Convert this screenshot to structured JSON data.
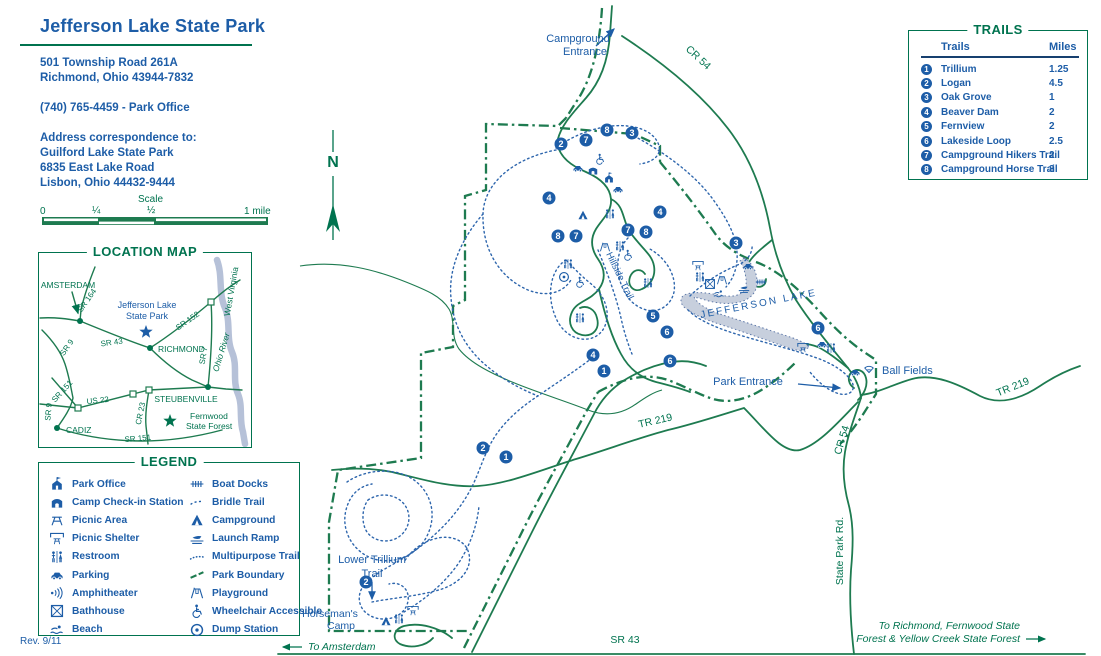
{
  "colors": {
    "blue": "#1d5da7",
    "green_text": "#00734f",
    "green_line": "#1e7b50",
    "lake_fill": "#c7cfdd",
    "marker_bg": "#1d5da7"
  },
  "header": {
    "title": "Jefferson Lake State Park",
    "lines": [
      "501 Township Road 261A",
      "Richmond, Ohio 43944-7832",
      "",
      "(740) 765-4459 - Park Office",
      "",
      "Address correspondence to:",
      "Guilford Lake State Park",
      "6835 East Lake Road",
      "Lisbon, Ohio 44432-9444"
    ]
  },
  "scale": {
    "title": "Scale",
    "ticks": [
      "0",
      "¼",
      "½",
      "1 mile"
    ]
  },
  "location_map": {
    "title": "LOCATION MAP",
    "city_dots": [
      {
        "x": 80,
        "y": 321
      },
      {
        "x": 150,
        "y": 348
      },
      {
        "x": 208,
        "y": 387
      },
      {
        "x": 57,
        "y": 428
      }
    ],
    "squares": [
      {
        "x": 211,
        "y": 302
      },
      {
        "x": 133,
        "y": 394
      },
      {
        "x": 149,
        "y": 390
      },
      {
        "x": 78,
        "y": 408
      }
    ],
    "stars": [
      {
        "x": 146,
        "y": 332,
        "c": "#1d5da7"
      },
      {
        "x": 170,
        "y": 421,
        "c": "#00734f"
      }
    ]
  },
  "legend": {
    "title": "LEGEND",
    "columns": [
      [
        {
          "icon": "park-office",
          "label": "Park Office"
        },
        {
          "icon": "checkin",
          "label": "Camp Check-in Station"
        },
        {
          "icon": "picnic-area",
          "label": "Picnic Area"
        },
        {
          "icon": "picnic-shelter",
          "label": "Picnic Shelter"
        },
        {
          "icon": "restroom",
          "label": "Restroom"
        },
        {
          "icon": "parking",
          "label": "Parking"
        },
        {
          "icon": "amphitheater",
          "label": "Amphitheater"
        },
        {
          "icon": "bathhouse",
          "label": "Bathhouse"
        },
        {
          "icon": "beach",
          "label": "Beach"
        }
      ],
      [
        {
          "icon": "boat-docks",
          "label": "Boat Docks"
        },
        {
          "icon": "bridle-trail",
          "label": "Bridle Trail"
        },
        {
          "icon": "campground",
          "label": "Campground"
        },
        {
          "icon": "launch-ramp",
          "label": "Launch Ramp"
        },
        {
          "icon": "multipurpose-trail",
          "label": "Multipurpose Trail"
        },
        {
          "icon": "park-boundary",
          "label": "Park Boundary"
        },
        {
          "icon": "playground",
          "label": "Playground"
        },
        {
          "icon": "wheelchair",
          "label": "Wheelchair Accessible"
        },
        {
          "icon": "dump-station",
          "label": "Dump Station"
        }
      ]
    ]
  },
  "trails_box": {
    "title": "TRAILS",
    "col_trails": "Trails",
    "col_miles": "Miles",
    "rows": [
      {
        "num": "1",
        "name": "Trillium",
        "miles": "1.25"
      },
      {
        "num": "2",
        "name": "Logan",
        "miles": "4.5"
      },
      {
        "num": "3",
        "name": "Oak Grove",
        "miles": "1"
      },
      {
        "num": "4",
        "name": "Beaver Dam",
        "miles": "2"
      },
      {
        "num": "5",
        "name": "Fernview",
        "miles": "2"
      },
      {
        "num": "6",
        "name": "Lakeside Loop",
        "miles": "2.5"
      },
      {
        "num": "7",
        "name": "Campground Hikers Trail",
        "miles": "2"
      },
      {
        "num": "8",
        "name": "Campground Horse Trail",
        "miles": "3"
      }
    ]
  },
  "map": {
    "labels": [
      {
        "text": "Campground",
        "x": 578,
        "y": 42,
        "color": "blue",
        "size": 11
      },
      {
        "text": "Entrance",
        "x": 585,
        "y": 55,
        "color": "blue",
        "size": 11
      },
      {
        "text": "CR 54",
        "x": 696,
        "y": 60,
        "color": "green",
        "size": 10.5,
        "rotate": 43
      },
      {
        "text": "N",
        "x": 333,
        "y": 167,
        "color": "green",
        "size": 16,
        "bold": true
      },
      {
        "text": "Hillside Trail",
        "x": 606,
        "y": 254,
        "color": "blue",
        "size": 9.5,
        "rotate": 64,
        "anchor": "start"
      },
      {
        "text": "JEFFERSON LAKE",
        "x": 701,
        "y": 318,
        "color": "blue",
        "size": 10,
        "rotate": -11,
        "anchor": "start",
        "spacing": 2.2
      },
      {
        "text": "Park Entrance",
        "x": 748,
        "y": 385,
        "color": "blue",
        "size": 11
      },
      {
        "text": "Ball Fields",
        "x": 882,
        "y": 374,
        "color": "blue",
        "size": 11,
        "anchor": "start"
      },
      {
        "text": "TR 219",
        "x": 1014,
        "y": 390,
        "color": "green",
        "size": 10.5,
        "rotate": -22
      },
      {
        "text": "TR 219",
        "x": 656,
        "y": 424,
        "color": "green",
        "size": 10.5,
        "rotate": -13
      },
      {
        "text": "CR 54",
        "x": 845,
        "y": 441,
        "color": "green",
        "size": 10.5,
        "rotate": -73
      },
      {
        "text": "State Park Rd.",
        "x": 843,
        "y": 551,
        "color": "green",
        "size": 10.5,
        "rotate": -90
      },
      {
        "text": "Lower Trillium",
        "x": 372,
        "y": 563,
        "color": "blue",
        "size": 11
      },
      {
        "text": "Trail",
        "x": 372,
        "y": 577,
        "color": "blue",
        "size": 11
      },
      {
        "text": "Horseman's",
        "x": 330,
        "y": 617,
        "color": "blue",
        "size": 10.5
      },
      {
        "text": "Camp",
        "x": 341,
        "y": 629,
        "color": "blue",
        "size": 10.5
      },
      {
        "text": "SR 43",
        "x": 625,
        "y": 643,
        "color": "green",
        "size": 10.5
      },
      {
        "text": "To Amsterdam",
        "x": 308,
        "y": 650,
        "color": "green",
        "size": 10.5,
        "italic": true,
        "anchor": "start"
      },
      {
        "text": "To Richmond, Fernwood State",
        "x": 1020,
        "y": 629,
        "color": "green",
        "size": 10.5,
        "italic": true,
        "anchor": "end"
      },
      {
        "text": "Forest & Yellow Creek State Forest",
        "x": 1020,
        "y": 642,
        "color": "green",
        "size": 10.5,
        "italic": true,
        "anchor": "end"
      },
      {
        "text": "AMSTERDAM",
        "x": 68,
        "y": 288,
        "color": "green",
        "size": 8.5
      },
      {
        "text": "SR 164",
        "x": 89,
        "y": 302,
        "color": "green",
        "size": 8,
        "rotate": -55
      },
      {
        "text": "Jefferson Lake",
        "x": 147,
        "y": 308,
        "color": "blue",
        "size": 9
      },
      {
        "text": "State Park",
        "x": 147,
        "y": 319,
        "color": "blue",
        "size": 9
      },
      {
        "text": "SR 152",
        "x": 189,
        "y": 323,
        "color": "green",
        "size": 8,
        "rotate": -35
      },
      {
        "text": "West Virginia",
        "x": 234,
        "y": 292,
        "color": "green",
        "size": 8.5,
        "rotate": -80
      },
      {
        "text": "Ohio River",
        "x": 224,
        "y": 353,
        "color": "green",
        "size": 8.5,
        "rotate": -73,
        "italic": true
      },
      {
        "text": "SR 43",
        "x": 112,
        "y": 345,
        "color": "green",
        "size": 8,
        "rotate": -8
      },
      {
        "text": "RICHMOND",
        "x": 158,
        "y": 352,
        "color": "green",
        "size": 8.5,
        "anchor": "start"
      },
      {
        "text": "SR 9",
        "x": 69,
        "y": 349,
        "color": "green",
        "size": 8,
        "rotate": -55
      },
      {
        "text": "SR 7",
        "x": 206,
        "y": 356,
        "color": "green",
        "size": 8,
        "rotate": -80
      },
      {
        "text": "SR 151",
        "x": 64,
        "y": 393,
        "color": "green",
        "size": 8,
        "rotate": -48
      },
      {
        "text": "US 22",
        "x": 98,
        "y": 403,
        "color": "green",
        "size": 8,
        "rotate": -6
      },
      {
        "text": "STEUBENVILLE",
        "x": 186,
        "y": 402,
        "color": "green",
        "size": 8.5
      },
      {
        "text": "CR 23",
        "x": 143,
        "y": 414,
        "color": "green",
        "size": 8,
        "rotate": -78
      },
      {
        "text": "Fernwood",
        "x": 190,
        "y": 419,
        "color": "green",
        "size": 8.5,
        "anchor": "start"
      },
      {
        "text": "State Forest",
        "x": 186,
        "y": 429,
        "color": "green",
        "size": 8.5,
        "anchor": "start"
      },
      {
        "text": "CADIZ",
        "x": 66,
        "y": 433,
        "color": "green",
        "size": 8.5,
        "anchor": "start"
      },
      {
        "text": "SR 9",
        "x": 51,
        "y": 412,
        "color": "green",
        "size": 8,
        "rotate": -85
      },
      {
        "text": "SR 151",
        "x": 138,
        "y": 441,
        "color": "green",
        "size": 8,
        "rotate": -5
      }
    ],
    "markers": [
      {
        "n": "2",
        "x": 561,
        "y": 144
      },
      {
        "n": "7",
        "x": 586,
        "y": 140
      },
      {
        "n": "8",
        "x": 607,
        "y": 130
      },
      {
        "n": "3",
        "x": 632,
        "y": 133
      },
      {
        "n": "4",
        "x": 549,
        "y": 198
      },
      {
        "n": "4",
        "x": 660,
        "y": 212
      },
      {
        "n": "8",
        "x": 558,
        "y": 236
      },
      {
        "n": "7",
        "x": 576,
        "y": 236
      },
      {
        "n": "7",
        "x": 628,
        "y": 230
      },
      {
        "n": "8",
        "x": 646,
        "y": 232
      },
      {
        "n": "3",
        "x": 736,
        "y": 243
      },
      {
        "n": "5",
        "x": 653,
        "y": 316
      },
      {
        "n": "6",
        "x": 667,
        "y": 332
      },
      {
        "n": "4",
        "x": 593,
        "y": 355
      },
      {
        "n": "1",
        "x": 604,
        "y": 371
      },
      {
        "n": "6",
        "x": 670,
        "y": 361
      },
      {
        "n": "6",
        "x": 818,
        "y": 328
      },
      {
        "n": "2",
        "x": 483,
        "y": 448
      },
      {
        "n": "1",
        "x": 506,
        "y": 457
      },
      {
        "n": "2",
        "x": 366,
        "y": 582
      }
    ],
    "icons": [
      {
        "k": "wheelchair",
        "x": 600,
        "y": 159
      },
      {
        "k": "parking",
        "x": 578,
        "y": 168
      },
      {
        "k": "checkin",
        "x": 593,
        "y": 170
      },
      {
        "k": "park-office",
        "x": 609,
        "y": 178
      },
      {
        "k": "parking",
        "x": 618,
        "y": 189
      },
      {
        "k": "campground",
        "x": 583,
        "y": 215
      },
      {
        "k": "restroom",
        "x": 610,
        "y": 214
      },
      {
        "k": "playground",
        "x": 605,
        "y": 247
      },
      {
        "k": "restroom",
        "x": 620,
        "y": 246
      },
      {
        "k": "wheelchair",
        "x": 628,
        "y": 255
      },
      {
        "k": "restroom",
        "x": 568,
        "y": 264
      },
      {
        "k": "dump-station",
        "x": 564,
        "y": 277
      },
      {
        "k": "wheelchair",
        "x": 580,
        "y": 282
      },
      {
        "k": "restroom",
        "x": 648,
        "y": 283
      },
      {
        "k": "restroom",
        "x": 580,
        "y": 318
      },
      {
        "k": "picnic-shelter",
        "x": 698,
        "y": 266
      },
      {
        "k": "restroom",
        "x": 700,
        "y": 277
      },
      {
        "k": "bathhouse",
        "x": 710,
        "y": 284
      },
      {
        "k": "playground",
        "x": 722,
        "y": 280
      },
      {
        "k": "beach",
        "x": 719,
        "y": 294
      },
      {
        "k": "parking",
        "x": 748,
        "y": 266
      },
      {
        "k": "launch-ramp",
        "x": 744,
        "y": 289
      },
      {
        "k": "boat-docks",
        "x": 761,
        "y": 282
      },
      {
        "k": "picnic-shelter",
        "x": 803,
        "y": 348
      },
      {
        "k": "parking",
        "x": 822,
        "y": 344
      },
      {
        "k": "restroom",
        "x": 831,
        "y": 348
      },
      {
        "k": "parking",
        "x": 855,
        "y": 372
      },
      {
        "k": "ballfield",
        "x": 869,
        "y": 368
      },
      {
        "k": "campground",
        "x": 386,
        "y": 621
      },
      {
        "k": "restroom",
        "x": 399,
        "y": 619
      },
      {
        "k": "picnic-shelter",
        "x": 413,
        "y": 611
      }
    ]
  },
  "footer": {
    "rev": "Rev. 9/11"
  }
}
